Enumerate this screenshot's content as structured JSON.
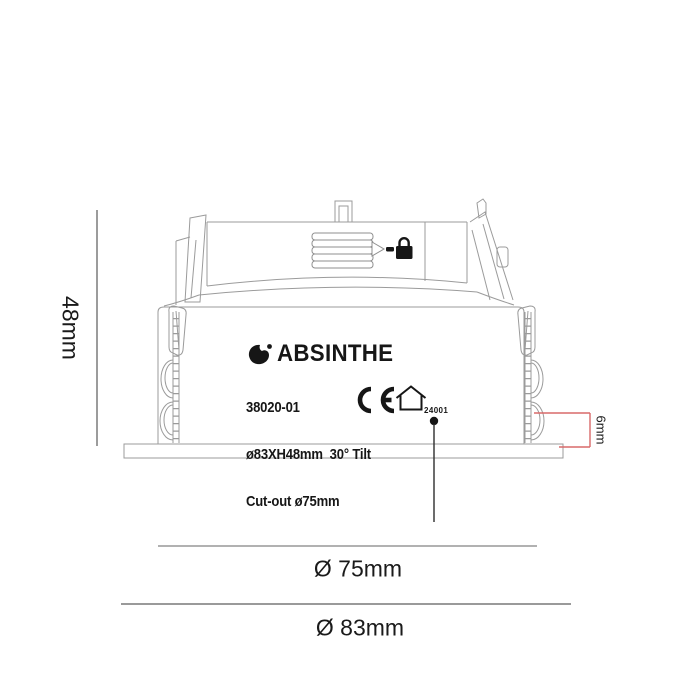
{
  "label": {
    "brand": "ABSINTHE",
    "model": "38020-01",
    "spec": "ø83XH48mm  30° Tilt",
    "cutout": "Cut-out ø75mm",
    "cert_number": "24001"
  },
  "dimensions": {
    "height": "48mm",
    "recess_depth": "6mm",
    "cutout_diameter": "Ø 75mm",
    "overall_diameter": "Ø 83mm"
  },
  "icons": {
    "brand_bird": "bird-logo-icon",
    "lock": "lock-icon",
    "arrow": "right-arrow-icon",
    "ce": "ce-mark",
    "house": "house-indoor-icon"
  },
  "colors": {
    "outline_gray": "#9b9b9b",
    "dimension_gray": "#787878",
    "dimension_red": "#d96a6a",
    "ink_black": "#161616"
  }
}
